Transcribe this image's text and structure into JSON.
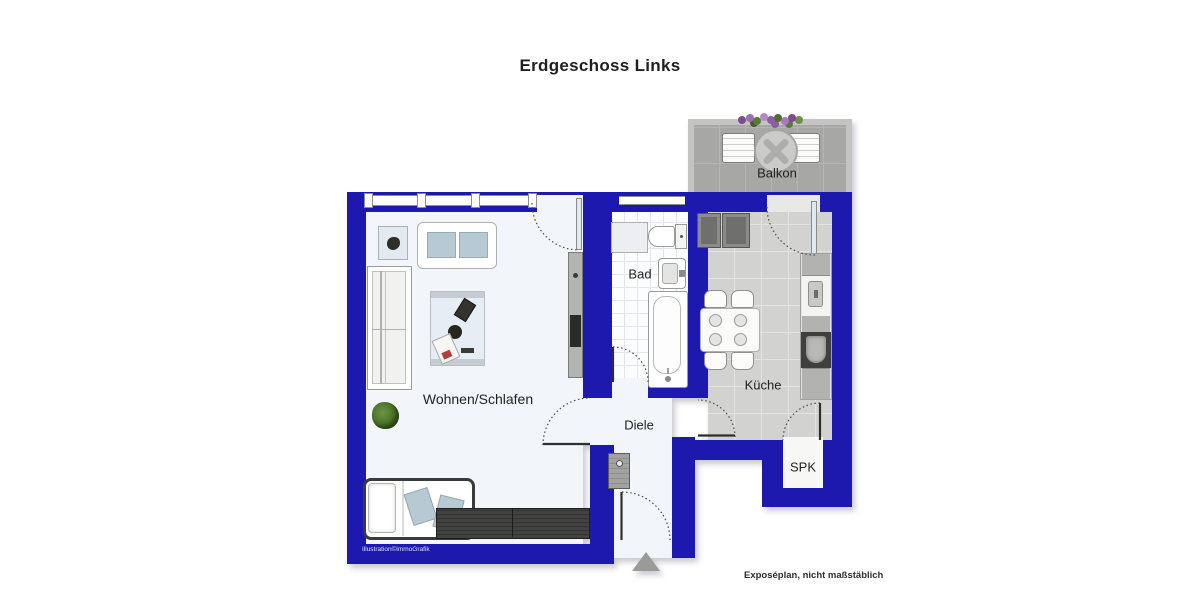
{
  "title": "Erdgeschoss Links",
  "rooms": {
    "living": "Wohnen/Schlafen",
    "bath": "Bad",
    "kitchen": "Küche",
    "hall": "Diele",
    "pantry": "SPK",
    "balcony": "Balkon"
  },
  "credit": "Illustration©immoGrafik",
  "footer": "Exposéplan, nicht maßstäblich",
  "colors": {
    "wall": "#1d19ae",
    "room_floor": "#f2f5fa",
    "kitchen_floor": "#d2d2d0",
    "balcony_floor": "#a7a7a5",
    "cushion": "#b7c9d3",
    "dark_furniture": "#3e3e3c"
  }
}
